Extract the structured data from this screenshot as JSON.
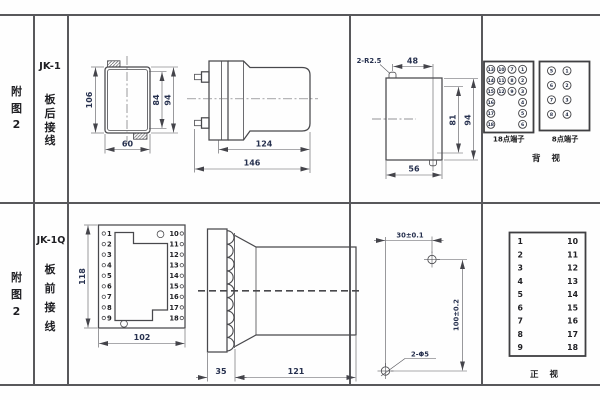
{
  "rows": {
    "r1": {
      "fig": {
        "c0": "附",
        "c1": "图",
        "c2": "2"
      },
      "model": "JK-1",
      "wiring": {
        "c0": "板",
        "c1": "后",
        "c2": "接",
        "c3": "线"
      },
      "rear": {
        "h": "106",
        "inner_h": "84",
        "outer_h": "94",
        "w": "60"
      },
      "side": {
        "body": "124",
        "total": "146"
      },
      "cutout": {
        "radius_note": "2-R2.5",
        "top_w": "48",
        "inner_h": "81",
        "outer_h": "94",
        "w": "56"
      },
      "t18": {
        "label": "18点端子",
        "col1": [
          "13",
          "14",
          "15",
          "16",
          "17",
          "18"
        ],
        "col2": [
          "10",
          "11",
          "12"
        ],
        "col3": [
          "7",
          "8",
          "9"
        ],
        "col4": [
          "1",
          "2",
          "3",
          "4",
          "5",
          "6"
        ]
      },
      "t8": {
        "label": "8点端子",
        "col1": [
          "5",
          "6",
          "7",
          "8"
        ],
        "col2": [
          "1",
          "2",
          "3",
          "4"
        ]
      },
      "view": "背 视"
    },
    "r2": {
      "fig": {
        "c0": "附",
        "c1": "图",
        "c2": "2"
      },
      "model": "JK-1Q",
      "wiring": {
        "c0": "板",
        "c1": "前",
        "c2": "接",
        "c3": "线"
      },
      "front": {
        "h": "118",
        "w": "102"
      },
      "side": {
        "plate": "35",
        "body": "121"
      },
      "drill": {
        "dx": "30±0.1",
        "dy": "100±0.2",
        "holes": "2-Φ5"
      },
      "nums_left": [
        "1",
        "2",
        "3",
        "4",
        "5",
        "6",
        "7",
        "8",
        "9"
      ],
      "nums_right": [
        "10",
        "11",
        "12",
        "13",
        "14",
        "15",
        "16",
        "17",
        "18"
      ],
      "view": "正 视"
    }
  }
}
